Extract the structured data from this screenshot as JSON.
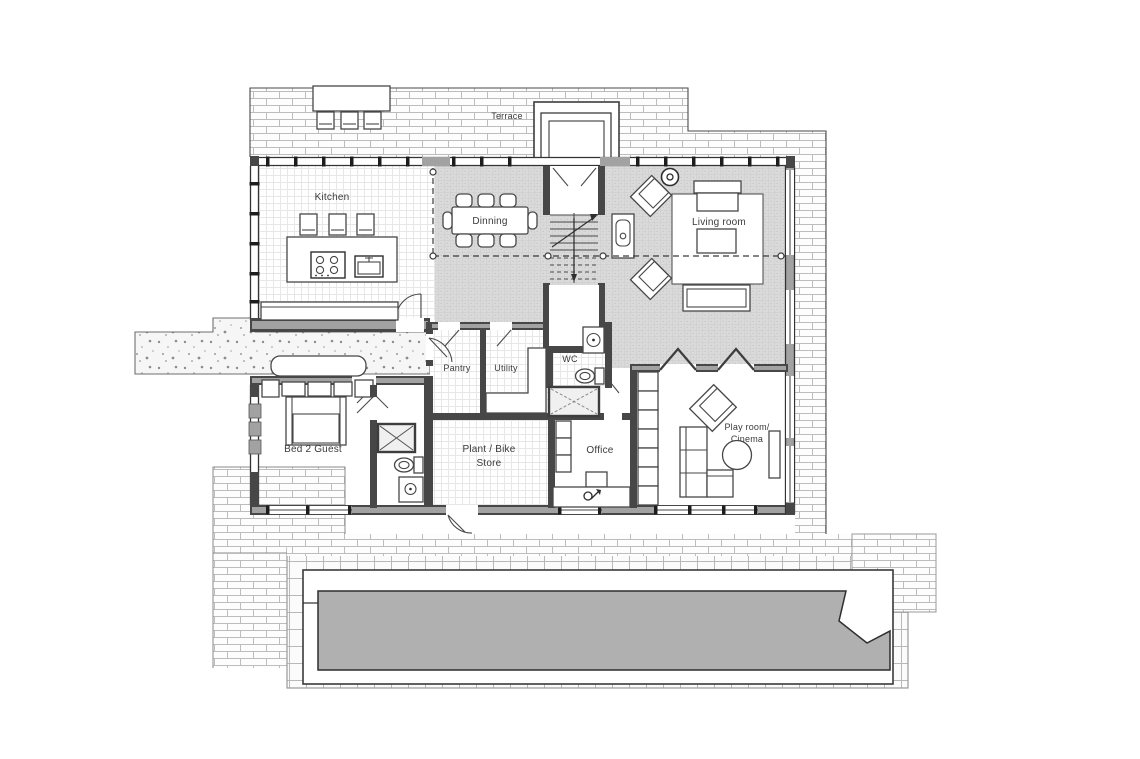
{
  "drawing": {
    "type": "architectural-floor-plan",
    "labels": {
      "terrace": "Terrace",
      "kitchen": "Kitchen",
      "dining": "Dinning",
      "living_room": "Living room",
      "pantry": "Pantry",
      "utility": "Utility",
      "wc": "WC",
      "bed2_guest": "Bed 2 Guest",
      "plant_bike_line1": "Plant / Bike",
      "plant_bike_line2": "Store",
      "office": "Office",
      "play_room_line1": "Play room/",
      "play_room_line2": "Cinema"
    },
    "colors": {
      "paper": "#ffffff",
      "wall_dark": "#474747",
      "wall_fill": "#a2a2a2",
      "interior_gray_floor": "#dadada",
      "pool_water": "#b0b0b0",
      "brick_line": "#bdbdbd",
      "text": "#3a3a3a"
    }
  }
}
